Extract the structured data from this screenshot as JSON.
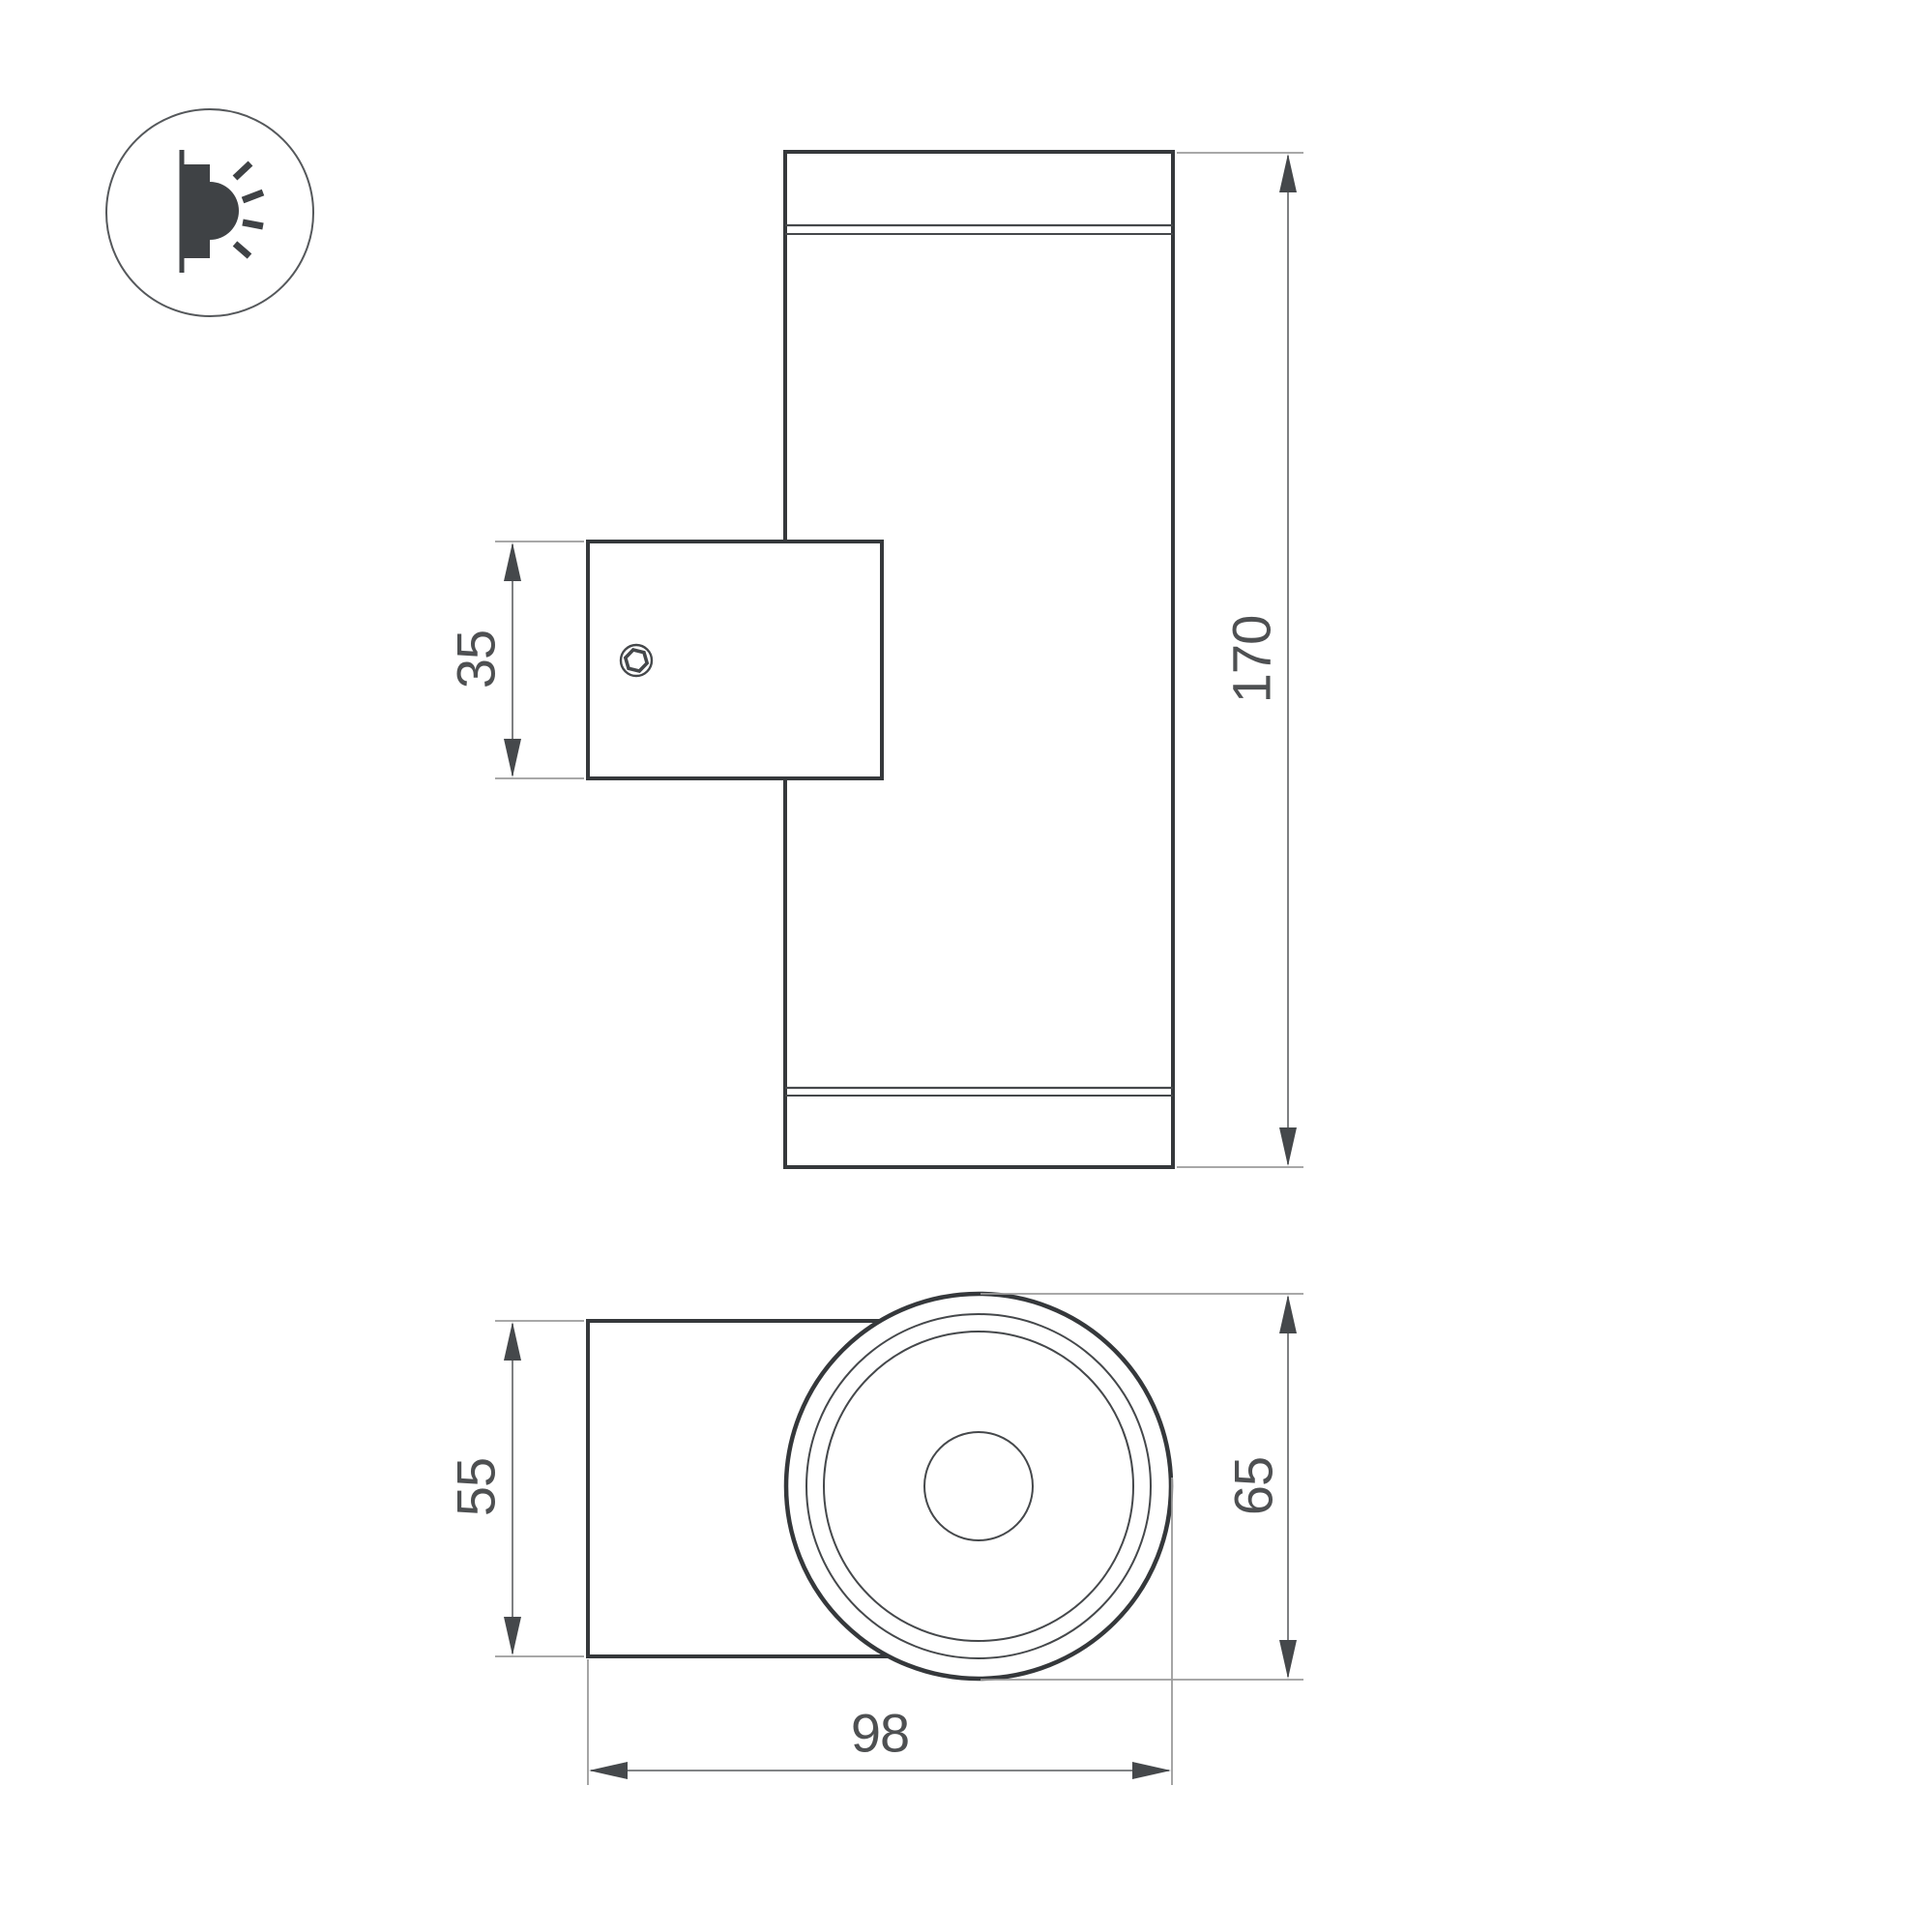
{
  "drawing": {
    "type": "technical-dimension-drawing",
    "views": {
      "front_view": "wall-mounted cylindrical luminaire, front elevation with mounting bracket",
      "top_view": "luminaire seen along axis: mounting box and round face"
    },
    "dimensions": {
      "bracket_height_mm": "35",
      "body_height_mm": "170",
      "body_width_mm": "55",
      "face_diameter_mm": "65",
      "depth_mm": "98"
    },
    "legend_icon": "wall-light-side-emission",
    "colors": {
      "background": "#ffffff",
      "main_line": "#35383b",
      "thin_line": "#45484b",
      "extension_line": "#9b9b9b",
      "dimension_line": "#707274",
      "arrow": "#45484b",
      "text": "#4e5052"
    }
  }
}
